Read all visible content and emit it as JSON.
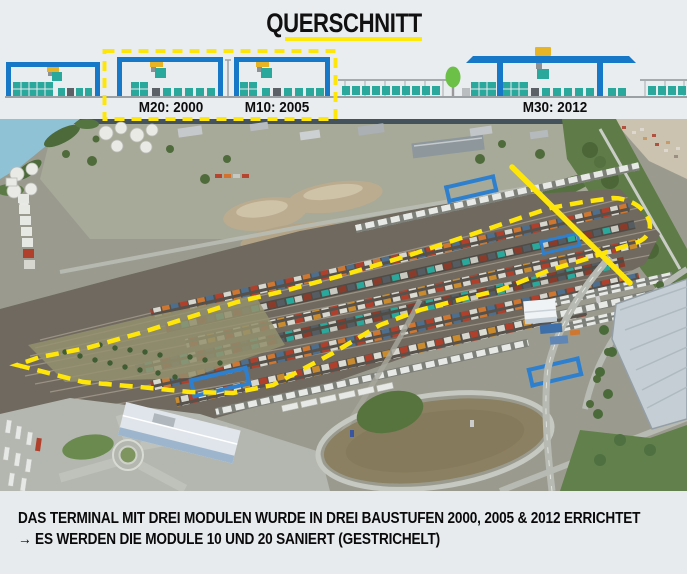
{
  "header": {
    "title": "QUERSCHNITT"
  },
  "cross_section": {
    "modules": [
      {
        "id": "M20",
        "label": "M20: 2000",
        "renovated": true
      },
      {
        "id": "M10",
        "label": "M10: 2005",
        "renovated": true
      },
      {
        "id": "M30",
        "label": "M30: 2012",
        "renovated": false
      }
    ]
  },
  "caption": {
    "line1": "DAS TERMINAL MIT DREI MODULEN WURDE IN DREI BAUSTUFEN 2000, 2005 & 2012 ERRICHTET",
    "line2": "→ ES WERDEN DIE MODULE 10 UND 20 SANIERT (GESTRICHELT)"
  },
  "colors": {
    "accent_yellow": "#FFE60A",
    "crane_blue": "#1878C8",
    "container_teal": "#2AA89B",
    "background": "#E9EDF0"
  }
}
